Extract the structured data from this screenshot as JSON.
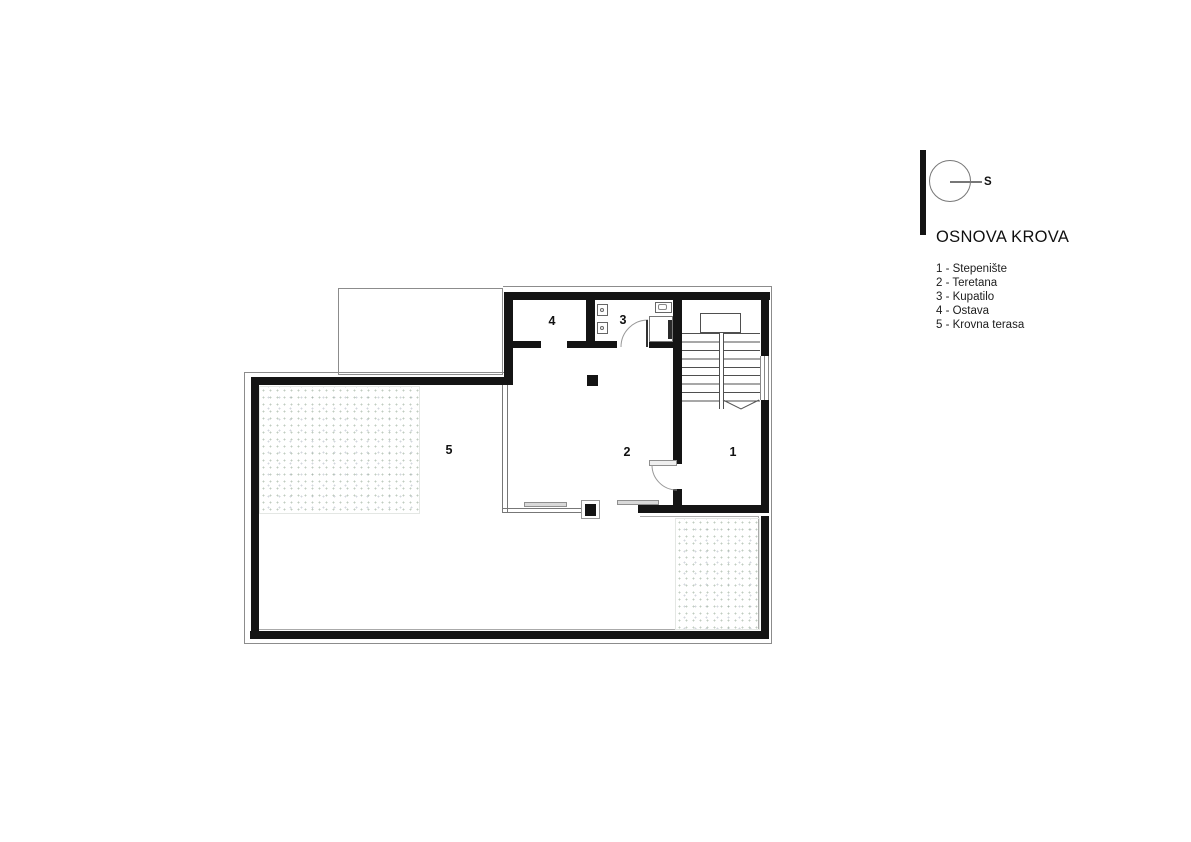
{
  "drawing": {
    "title": "OSNOVA KROVA",
    "north_label": "S",
    "ink_color": "#141414",
    "outline_color": "#8c8c8c",
    "texture_dot_color": "#8ca28c"
  },
  "legend": {
    "items": [
      {
        "text": "1 - Stepenište"
      },
      {
        "text": "2 - Teretana"
      },
      {
        "text": "3 - Kupatilo"
      },
      {
        "text": "4 - Ostava"
      },
      {
        "text": "5 - Krovna terasa"
      }
    ]
  },
  "rooms": [
    {
      "num": "1"
    },
    {
      "num": "2"
    },
    {
      "num": "3"
    },
    {
      "num": "4"
    },
    {
      "num": "5"
    }
  ]
}
